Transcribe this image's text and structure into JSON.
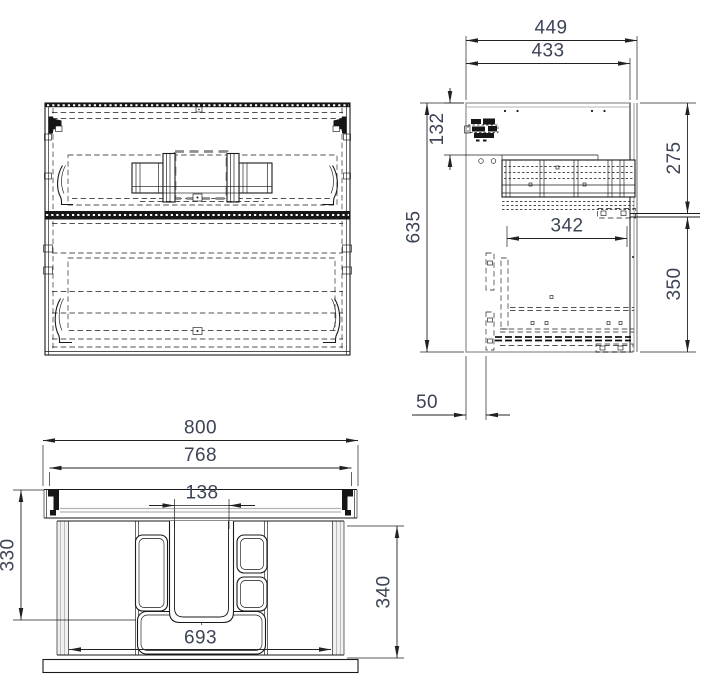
{
  "colors": {
    "line": "#1a1a1a",
    "edge_gray": "#a8a8a8",
    "dim_text": "#3d4456",
    "hidden_bold_dash": "#8d8d8d",
    "background": "#ffffff"
  },
  "side_view": {
    "dims": {
      "overall_depth": "449",
      "carcass_depth": "433",
      "top_offset": "132",
      "overall_height": "635",
      "upper_drawer_zone": "275",
      "runner_length": "342",
      "lower_drawer_zone": "350",
      "back_clearance": "50"
    }
  },
  "plan_view": {
    "dims": {
      "overall_width": "800",
      "carcass_width": "768",
      "channel_width": "138",
      "depth_to_channel": "330",
      "inner_depth": "340",
      "inner_width": "693"
    }
  }
}
